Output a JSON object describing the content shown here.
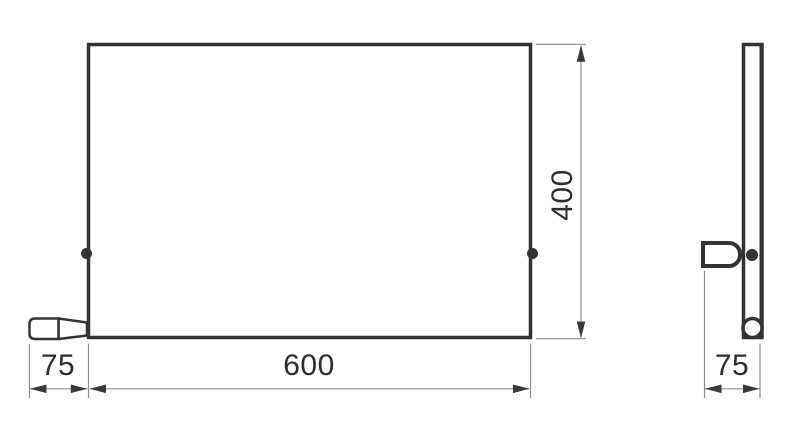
{
  "drawing": {
    "labels": {
      "width": "600",
      "height": "400",
      "front_overhang": "75",
      "depth": "75"
    },
    "colors": {
      "outline": "#333333",
      "dimension_lines": "#8c8c8c",
      "arrowheads": "#3a3a3a",
      "label_text": "#2d2d2d",
      "background": "#ffffff"
    }
  }
}
